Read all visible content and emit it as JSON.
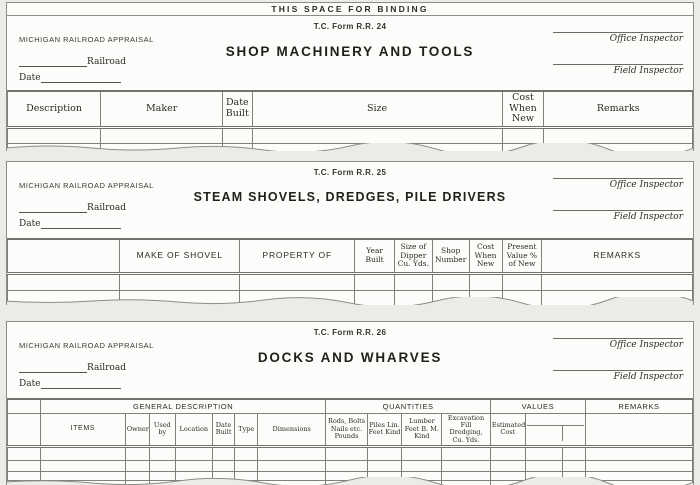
{
  "page": {
    "binding_label": "THIS SPACE FOR BINDING"
  },
  "forms": [
    {
      "form_number": "T.C. Form R.R. 24",
      "agency": "MICHIGAN RAILROAD APPRAISAL",
      "railroad_label": "Railroad",
      "date_label": "Date",
      "title": "SHOP MACHINERY AND TOOLS",
      "office_inspector_label": "Office Inspector",
      "field_inspector_label": "Field Inspector",
      "table": {
        "columns": [
          "Description",
          "Maker",
          "Date Built",
          "Size",
          "Cost When New",
          "Remarks"
        ],
        "empty_body_rows": 2
      }
    },
    {
      "form_number": "T.C. Form R.R. 25",
      "agency": "MICHIGAN RAILROAD APPRAISAL",
      "railroad_label": "Railroad",
      "date_label": "Date",
      "title": "STEAM SHOVELS, DREDGES, PILE DRIVERS",
      "office_inspector_label": "Office Inspector",
      "field_inspector_label": "Field Inspector",
      "table": {
        "columns": [
          "",
          "MAKE OF SHOVEL",
          "PROPERTY OF",
          "Year Built",
          "Size of Dipper Cu. Yds.",
          "Shop Number",
          "Cost When New",
          "Present Value % of New",
          "REMARKS"
        ],
        "empty_body_rows": 2
      }
    },
    {
      "form_number": "T.C. Form R.R. 26",
      "agency": "MICHIGAN RAILROAD APPRAISAL",
      "railroad_label": "Railroad",
      "date_label": "Date",
      "title": "DOCKS AND WHARVES",
      "office_inspector_label": "Office Inspector",
      "field_inspector_label": "Field Inspector",
      "table": {
        "groups": [
          "GENERAL DESCRIPTION",
          "QUANTITIES",
          "VALUES",
          "REMARKS"
        ],
        "columns": [
          "ITEMS",
          "Owner",
          "Used by",
          "Location",
          "Date Built",
          "Type",
          "Dimensions",
          "Rods, Bolts Nails etc. Pounds",
          "Piles Lin. Feet Kind",
          "Lumber Feet B. M. Kind",
          "Excavation Fill Dredging, Cu. Yds.",
          "Estimated Cost"
        ],
        "empty_body_rows": 4
      }
    }
  ]
}
